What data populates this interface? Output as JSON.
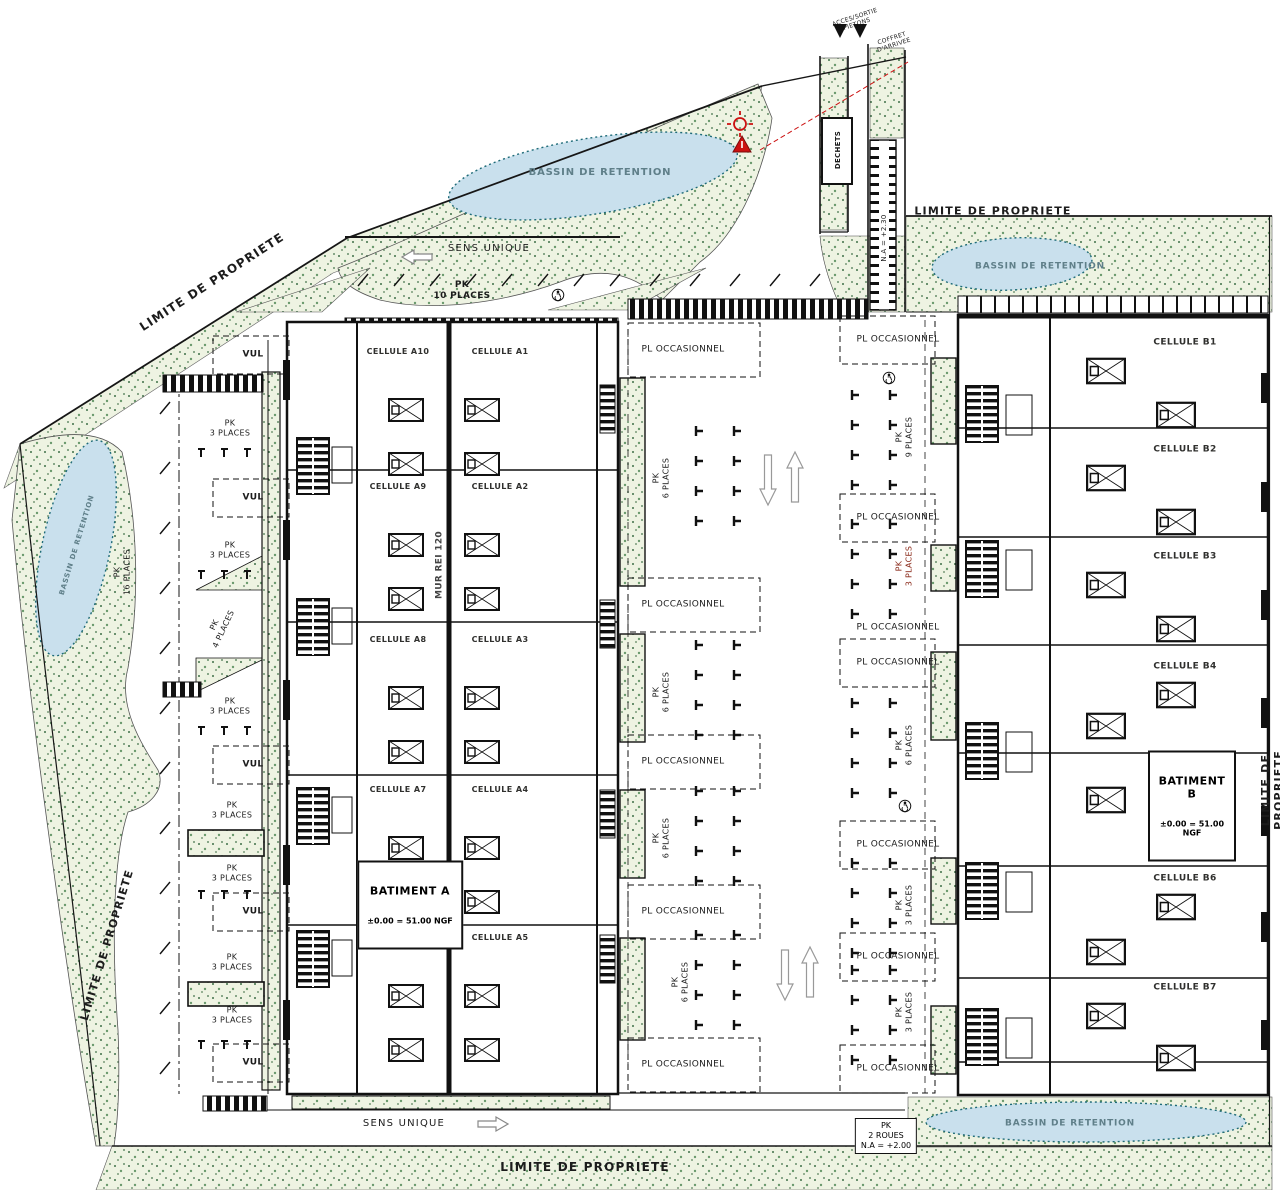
{
  "labels": {
    "limite_de_propriete": "LIMITE DE PROPRIETE",
    "bassin_de_retention": "BASSIN DE RETENTION",
    "sens_unique": "SENS UNIQUE",
    "pl_occasionnel": "PL OCCASIONNEL",
    "vul": "VUL",
    "pk_10_places": "PK\n10 PLACES",
    "pk_3_places": "PK\n3 PLACES",
    "pk_4_places": "PK\n4 PLACES",
    "pk_16_places": "PK\n16 PLACES",
    "pk_6_places": "PK\n6 PLACES",
    "pk_9_places": "PK\n9 PLACES",
    "pk_2_roues": "PK\n2 ROUES\nN.A = +2.00",
    "mur_rei": "MUR REI 120",
    "dechets": "DECHETS",
    "na_230": "N.A = +2.30",
    "acces_sortie": "ACCES/SORTIE\nPIETONS",
    "coffret": "COFFRET\nD'ARRIVEE"
  },
  "batiment_a": {
    "name": "BATIMENT A",
    "level": "±0.00 = 51.00 NGF",
    "cells_west": [
      "CELLULE A10",
      "CELLULE A9",
      "CELLULE A8",
      "CELLULE A7",
      "CELLULE A6"
    ],
    "cells_east": [
      "CELLULE A1",
      "CELLULE A2",
      "CELLULE A3",
      "CELLULE A4",
      "CELLULE A5"
    ]
  },
  "batiment_b": {
    "name": "BATIMENT B",
    "level": "±0.00 = 51.00 NGF",
    "cells": [
      "CELLULE B1",
      "CELLULE B2",
      "CELLULE B3",
      "CELLULE B4",
      "CELLULE B5",
      "CELLULE B6",
      "CELLULE B7"
    ]
  },
  "colors": {
    "line": "#161616",
    "green_fill": "#eef3e2",
    "green_dot": "#3f7048",
    "pond_fill": "#c9e0ed",
    "pond_edge": "#1e6b78",
    "alert_red": "#cc1111"
  }
}
